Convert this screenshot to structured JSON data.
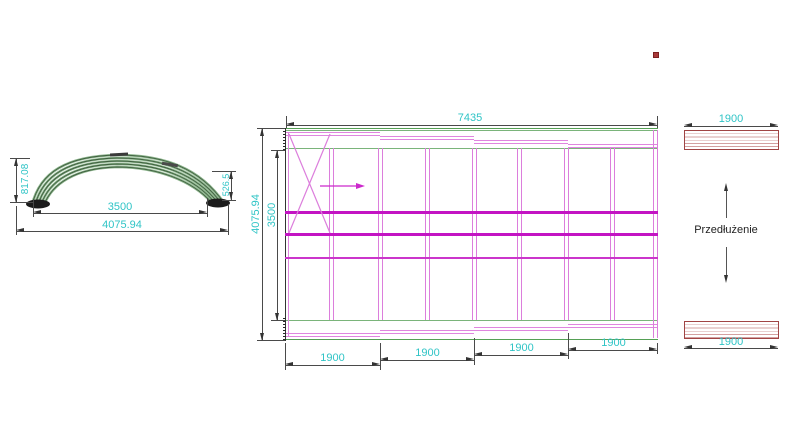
{
  "drawing": {
    "elevation": {
      "height_left": "817.08",
      "height_right": "526.5",
      "width_inner": "3500",
      "width_outer": "4075.94"
    },
    "plan": {
      "width_top": "7435",
      "height_outer": "4075.94",
      "height_inner": "3500",
      "segments": [
        "1900",
        "1900",
        "1900",
        "1900"
      ]
    },
    "extension": {
      "label": "Przedłużenie",
      "dim_top": "1900",
      "dim_bottom": "1900"
    }
  },
  "colors": {
    "dimension_text": "#2fc4c6",
    "structure_magenta": "#c314c3",
    "frame_green": "#7ab47a",
    "extension_bar": "#a04444",
    "marker_red": "#a93a3a"
  }
}
